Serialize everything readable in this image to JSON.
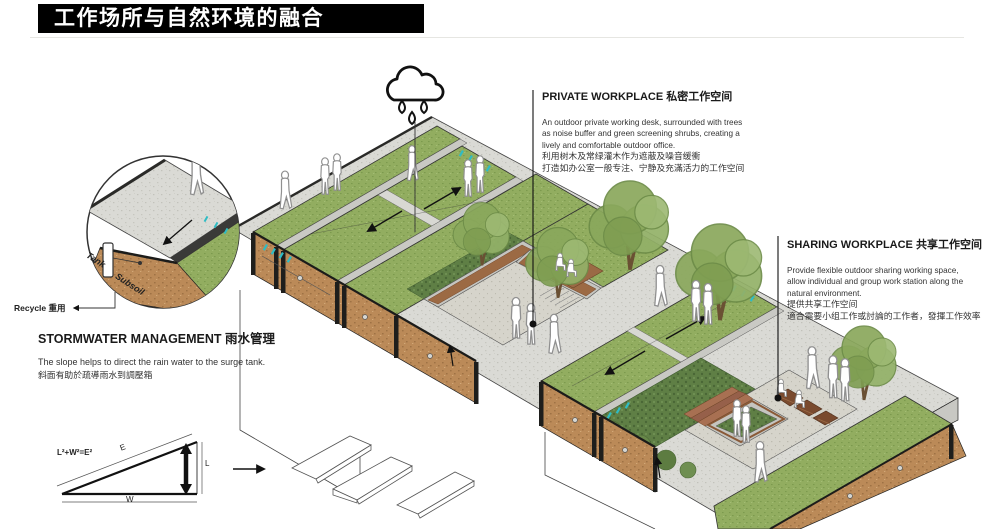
{
  "title": "工作场所与自然环境的融合",
  "callouts": {
    "private": {
      "title": "PRIVATE WORKPLACE 私密工作空间",
      "lines": [
        "An outdoor private working desk,  surrounded with trees",
        "as noise buffer and green screening shrubs, creating a",
        "lively and comfortable outdoor office.",
        "利用树木及常绿灌木作为遮蔽及噪音缓衝",
        "打造如办公室一般专注、宁静及充滿活力的工作空间"
      ]
    },
    "sharing": {
      "title": "SHARING WORKPLACE 共享工作空间",
      "lines": [
        "Provide flexible outdoor sharing  working space,",
        "allow individual and  group work station along the",
        "natural environment.",
        "提供共享工作空间",
        "適合需要小组工作或討論的工作者，發揮工作效率"
      ]
    },
    "stormwater": {
      "title": "STORMWATER MANAGEMENT 雨水管理",
      "lines": [
        "The slope helps to direct the rain water to the surge tank.",
        "斜面有助於疏導雨水到調壓箱"
      ]
    },
    "recycle_label": "Recycle 重用"
  },
  "detail_circle": {
    "tank": "Tank",
    "subsoil": "Subsoil"
  },
  "slope_diagram": {
    "formula": "L²+W²=E²",
    "hypotenuse": "E",
    "height": "L",
    "width": "W"
  },
  "icons": {
    "rain": "rain-cloud-icon"
  },
  "colors": {
    "grass": "#92ad60",
    "grass_dark": "#7c9a4e",
    "soil": "#bb8a58",
    "pavement": "#dadad5",
    "wood": "#8a5a38",
    "teal_marker": "#2fbcc4",
    "shrub": "#5f7f45",
    "ink": "#111111"
  }
}
